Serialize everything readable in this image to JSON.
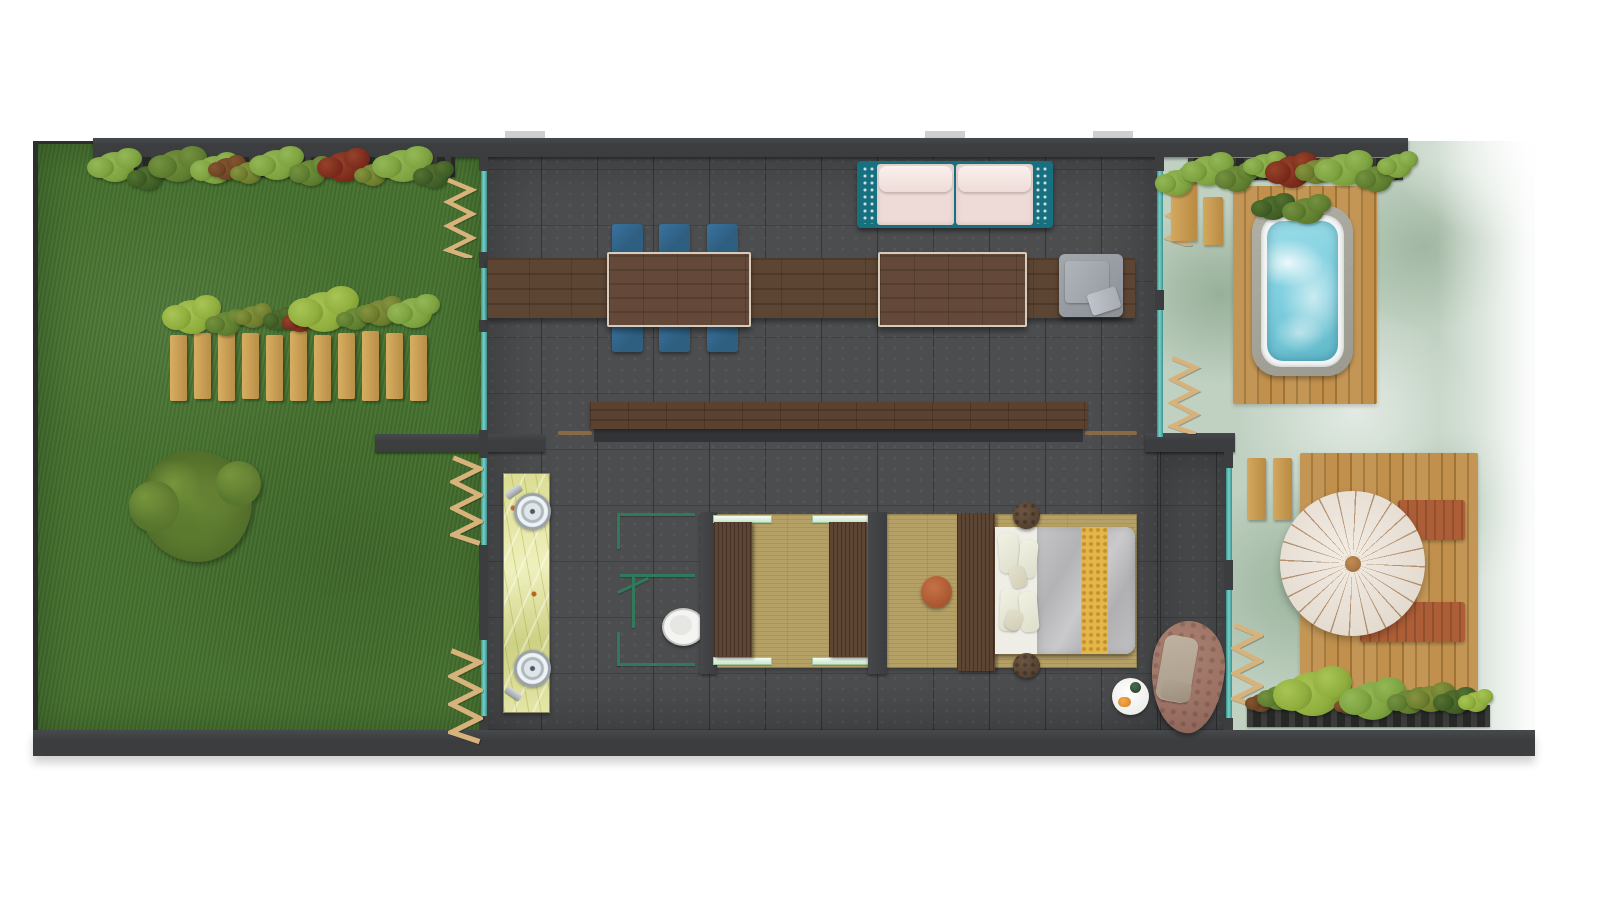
{
  "document": {
    "type": "floor-plan",
    "view": "top-down architectural render",
    "visible_text": [],
    "areas": [
      {
        "name": "garden-lawn",
        "position": "left"
      },
      {
        "name": "living-dining-room",
        "position": "center-top"
      },
      {
        "name": "bathroom-vanity-area",
        "position": "center-left"
      },
      {
        "name": "toilet-enclosure",
        "position": "center"
      },
      {
        "name": "dressing-area",
        "position": "center"
      },
      {
        "name": "bedroom",
        "position": "center-right"
      },
      {
        "name": "hot-tub-terrace",
        "position": "right-top"
      },
      {
        "name": "sun-deck-terrace",
        "position": "right-bottom"
      }
    ]
  },
  "inventory": {
    "dining_chairs": 6,
    "dining_tables": 2,
    "sofas": 1,
    "armchairs": 1,
    "wall_shelves": 1,
    "vanity_sinks": 2,
    "toilets": 1,
    "wardrobes": 2,
    "beds": 1,
    "bedside_stools": 2,
    "poufs": 1,
    "hanging_egg_chairs": 1,
    "breakfast_trays": 1,
    "hot_tubs": 1,
    "parasols": 1,
    "sun_loungers": 2,
    "privacy_screens": 6,
    "stepping_planks": 4,
    "planter_beds": 4,
    "picket_fences": 1,
    "trees": 1
  },
  "palette": {
    "lawn_green": "#46722f",
    "sage_green": "#c0d1c2",
    "tile_gray": "#4c4d4f",
    "wall_dark": "#3b3d3f",
    "glass_teal": "#74d2cb",
    "wood_dark": "#5d4533",
    "deck_wood": "#c0904c",
    "tatami_tan": "#b5a066",
    "sofa_teal": "#17707f",
    "cushion_pink": "#eedad6",
    "chair_blue": "#2e5f80",
    "runner_gold": "#e5b64a",
    "terracotta": "#ad5e36",
    "water_blue": "#7ccede",
    "partition_green": "#2e7a5a",
    "egg_brown": "#9b7164",
    "planter_dark": "#262826",
    "plant_g1": "#7da23f",
    "plant_g2": "#5e7d2f",
    "plant_g3": "#3f5d26",
    "plant_g4": "#8fae3d",
    "plant_g5": "#6d7d2e",
    "plant_red": "#7c2b1c",
    "plant_rust": "#6e4526"
  }
}
